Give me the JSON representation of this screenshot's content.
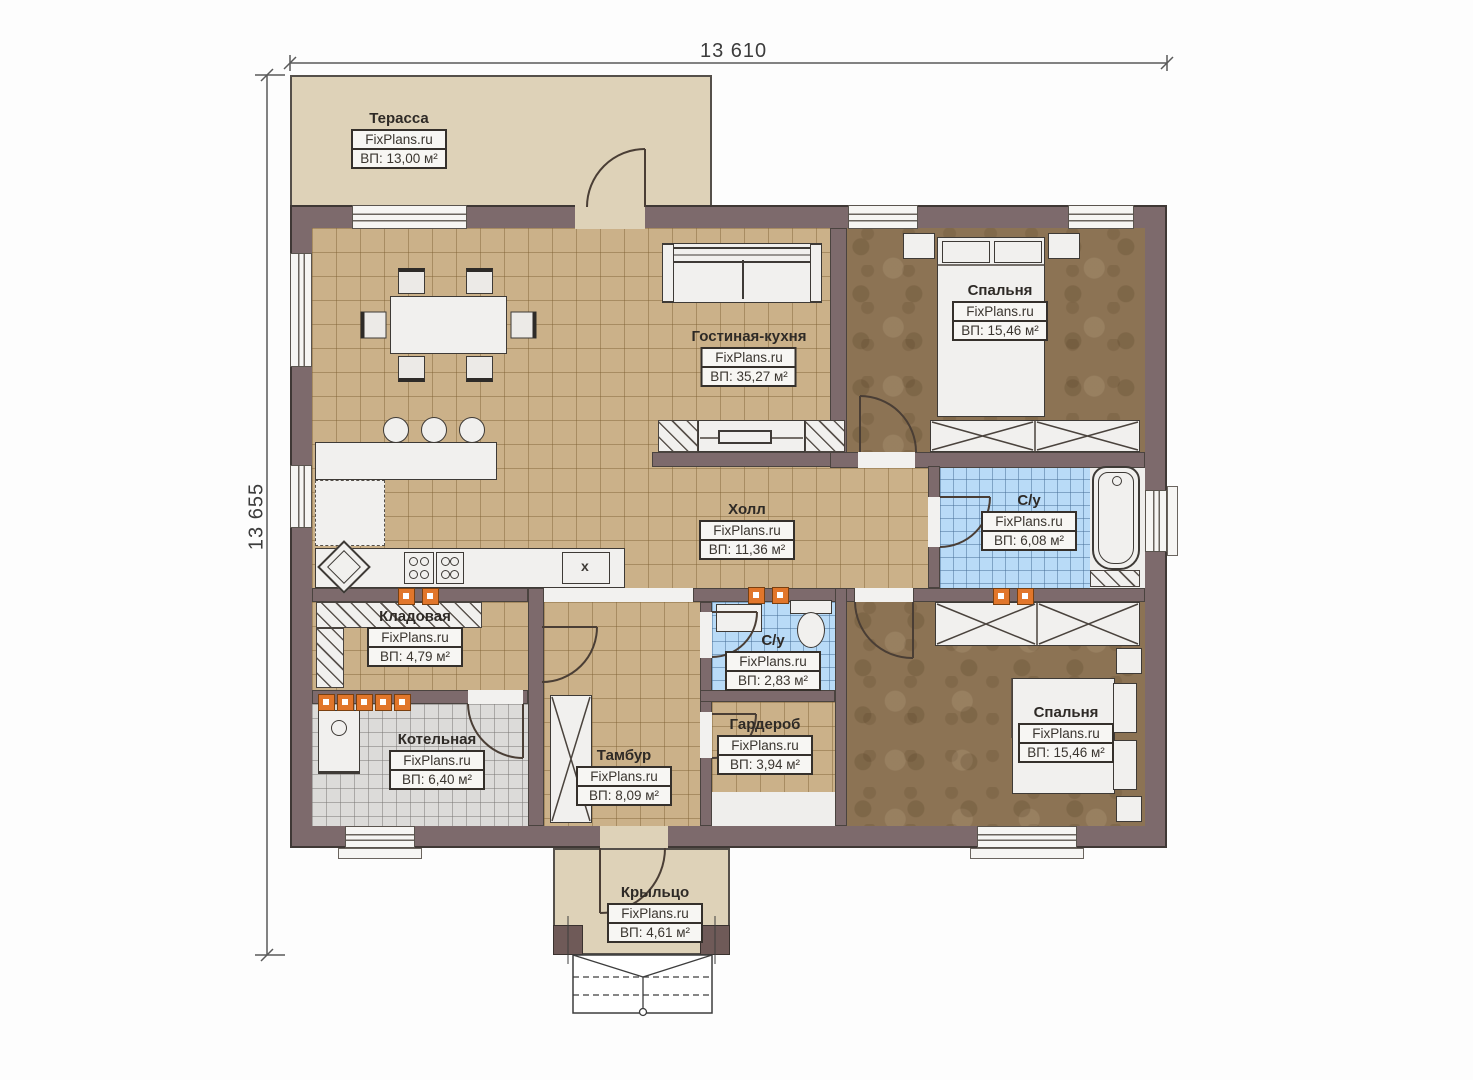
{
  "dimensions": {
    "width_label": "13 610",
    "height_label": "13 655"
  },
  "brand": "FixPlans.ru",
  "rooms": [
    {
      "name": "Терасса",
      "brand": "FixPlans.ru",
      "area": "ВП: 13,00 м²"
    },
    {
      "name": "Гостиная-кухня",
      "brand": "FixPlans.ru",
      "area": "ВП: 35,27 м²"
    },
    {
      "name": "Спальня",
      "brand": "FixPlans.ru",
      "area": "ВП: 15,46 м²"
    },
    {
      "name": "Холл",
      "brand": "FixPlans.ru",
      "area": "ВП: 11,36 м²"
    },
    {
      "name": "С/у",
      "brand": "FixPlans.ru",
      "area": "ВП: 6,08 м²"
    },
    {
      "name": "Кладовая",
      "brand": "FixPlans.ru",
      "area": "ВП: 4,79 м²"
    },
    {
      "name": "С/у",
      "brand": "FixPlans.ru",
      "area": "ВП: 2,83 м²"
    },
    {
      "name": "Гардероб",
      "brand": "FixPlans.ru",
      "area": "ВП: 3,94 м²"
    },
    {
      "name": "Котельная",
      "brand": "FixPlans.ru",
      "area": "ВП: 6,40 м²"
    },
    {
      "name": "Тамбур",
      "brand": "FixPlans.ru",
      "area": "ВП: 8,09 м²"
    },
    {
      "name": "Спальня",
      "brand": "FixPlans.ru",
      "area": "ВП: 15,46 м²"
    },
    {
      "name": "Крыльцо",
      "brand": "FixPlans.ru",
      "area": "ВП: 4,61 м²"
    }
  ],
  "kitchen": {
    "cabinet_mark": "x"
  },
  "colors": {
    "wall": "#7d6a6c",
    "tile_tan": "#cbb189",
    "floor_brown": "#8c7354",
    "tile_blue": "#b9dbf7",
    "tile_gray": "#dcdbd9",
    "terrace": "#ded2b8",
    "accent_orange": "#e1762b"
  }
}
